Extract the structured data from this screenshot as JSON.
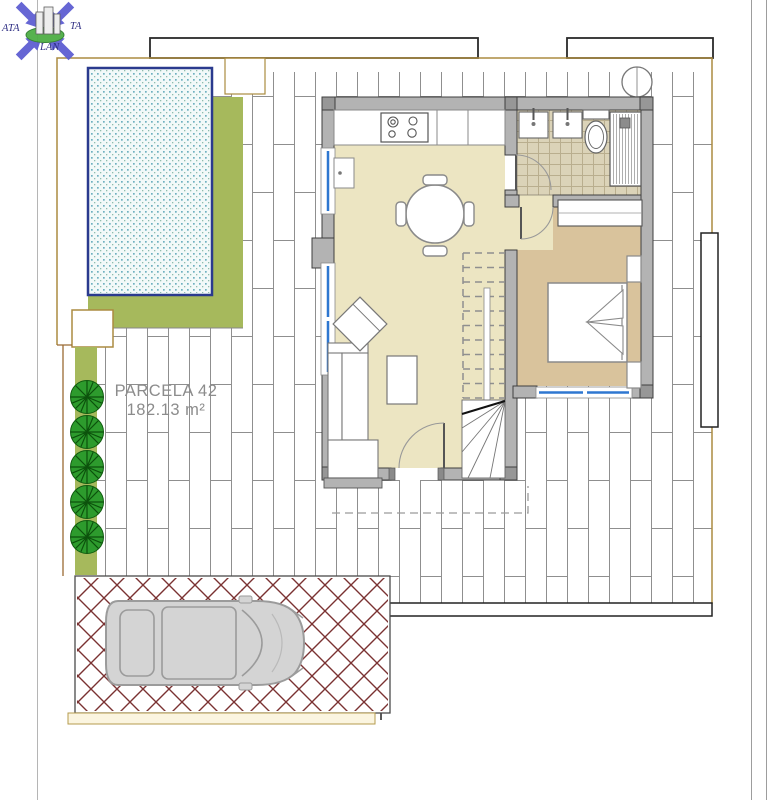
{
  "logo": {
    "fragment_left": "ATA",
    "fragment_right": "TA",
    "fragment_bottom": "LAN"
  },
  "plan": {
    "parcel_label_line1": "PARCELA 42",
    "parcel_label_line2": "182.13 m²"
  },
  "palette": {
    "lawn_green": "#a6b95c",
    "pool_water": "#f2f9f9",
    "pool_border": "#2a3a8e",
    "wall_gray": "#b3b3b3",
    "floor_cream": "#ece5c2",
    "floor_bedroom_tan": "#d9c39c",
    "bath_tile": "#dbd3b8",
    "paving_brick_red": "#7a3232",
    "window_blue": "#2e77d0",
    "shrub_green": "#2d9b2d",
    "boundary_tan": "#ab8b40",
    "car_body_gray": "#d4d4d4"
  }
}
